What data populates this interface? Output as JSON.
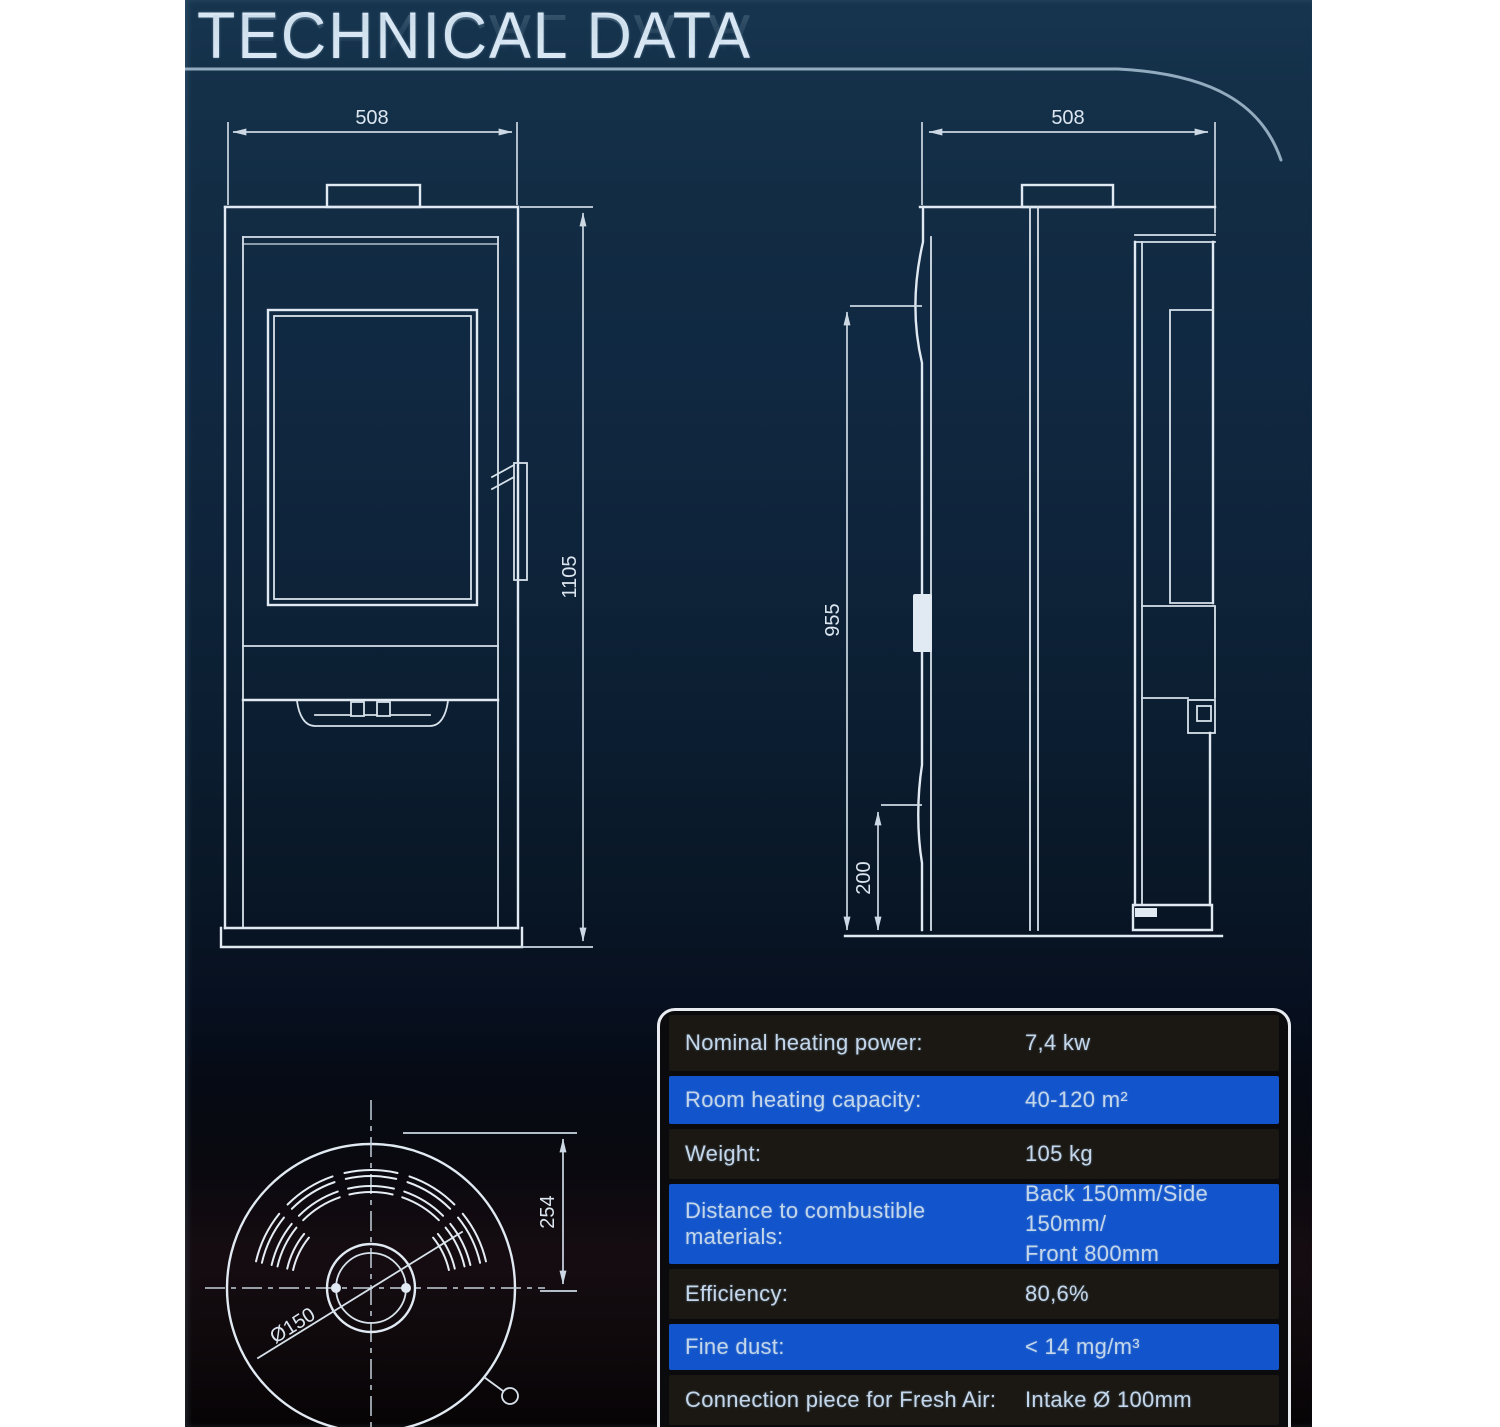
{
  "header": {
    "title": "TECHNICAL DATA"
  },
  "drawings": {
    "front_view": {
      "name": "stove-front-elevation",
      "width_dim": "508",
      "height_dim": "1105"
    },
    "side_view": {
      "name": "stove-side-elevation",
      "width_dim": "508",
      "height_dim": "955",
      "base_dim": "200"
    },
    "top_view": {
      "name": "stove-top-plan",
      "offset_dim": "254",
      "flue_dim": "Ø150"
    }
  },
  "spec_table": {
    "rows": [
      {
        "label": "Nominal heating power:",
        "value": "7,4 kw",
        "tone": "dark"
      },
      {
        "label": "Room heating capacity:",
        "value": "40-120 m²",
        "tone": "blue"
      },
      {
        "label": "Weight:",
        "value": "105 kg",
        "tone": "dark"
      },
      {
        "label": "Distance to combustible materials:",
        "value": "Back 150mm/Side 150mm/",
        "value_line2": "Front 800mm",
        "tone": "blue"
      },
      {
        "label": "Efficiency:",
        "value": "80,6%",
        "tone": "dark"
      },
      {
        "label": "Fine dust:",
        "value": "< 14 mg/m³",
        "tone": "blue"
      },
      {
        "label": "Connection piece for Fresh Air:",
        "value": "Intake Ø 100mm",
        "tone": "dark"
      },
      {
        "label": "",
        "value": "",
        "tone": "blue"
      }
    ],
    "colors": {
      "dark_row": "#1b1813",
      "blue_row": "#1254cb",
      "border": "#e8ebef",
      "text": "#c3d6ea"
    }
  },
  "palette": {
    "page_margin": "#ffffff",
    "panel_top": "#17354f",
    "panel_bottom": "#070406",
    "drawing_line": "#e1eaf2",
    "title_color": "#d8e7f3"
  }
}
